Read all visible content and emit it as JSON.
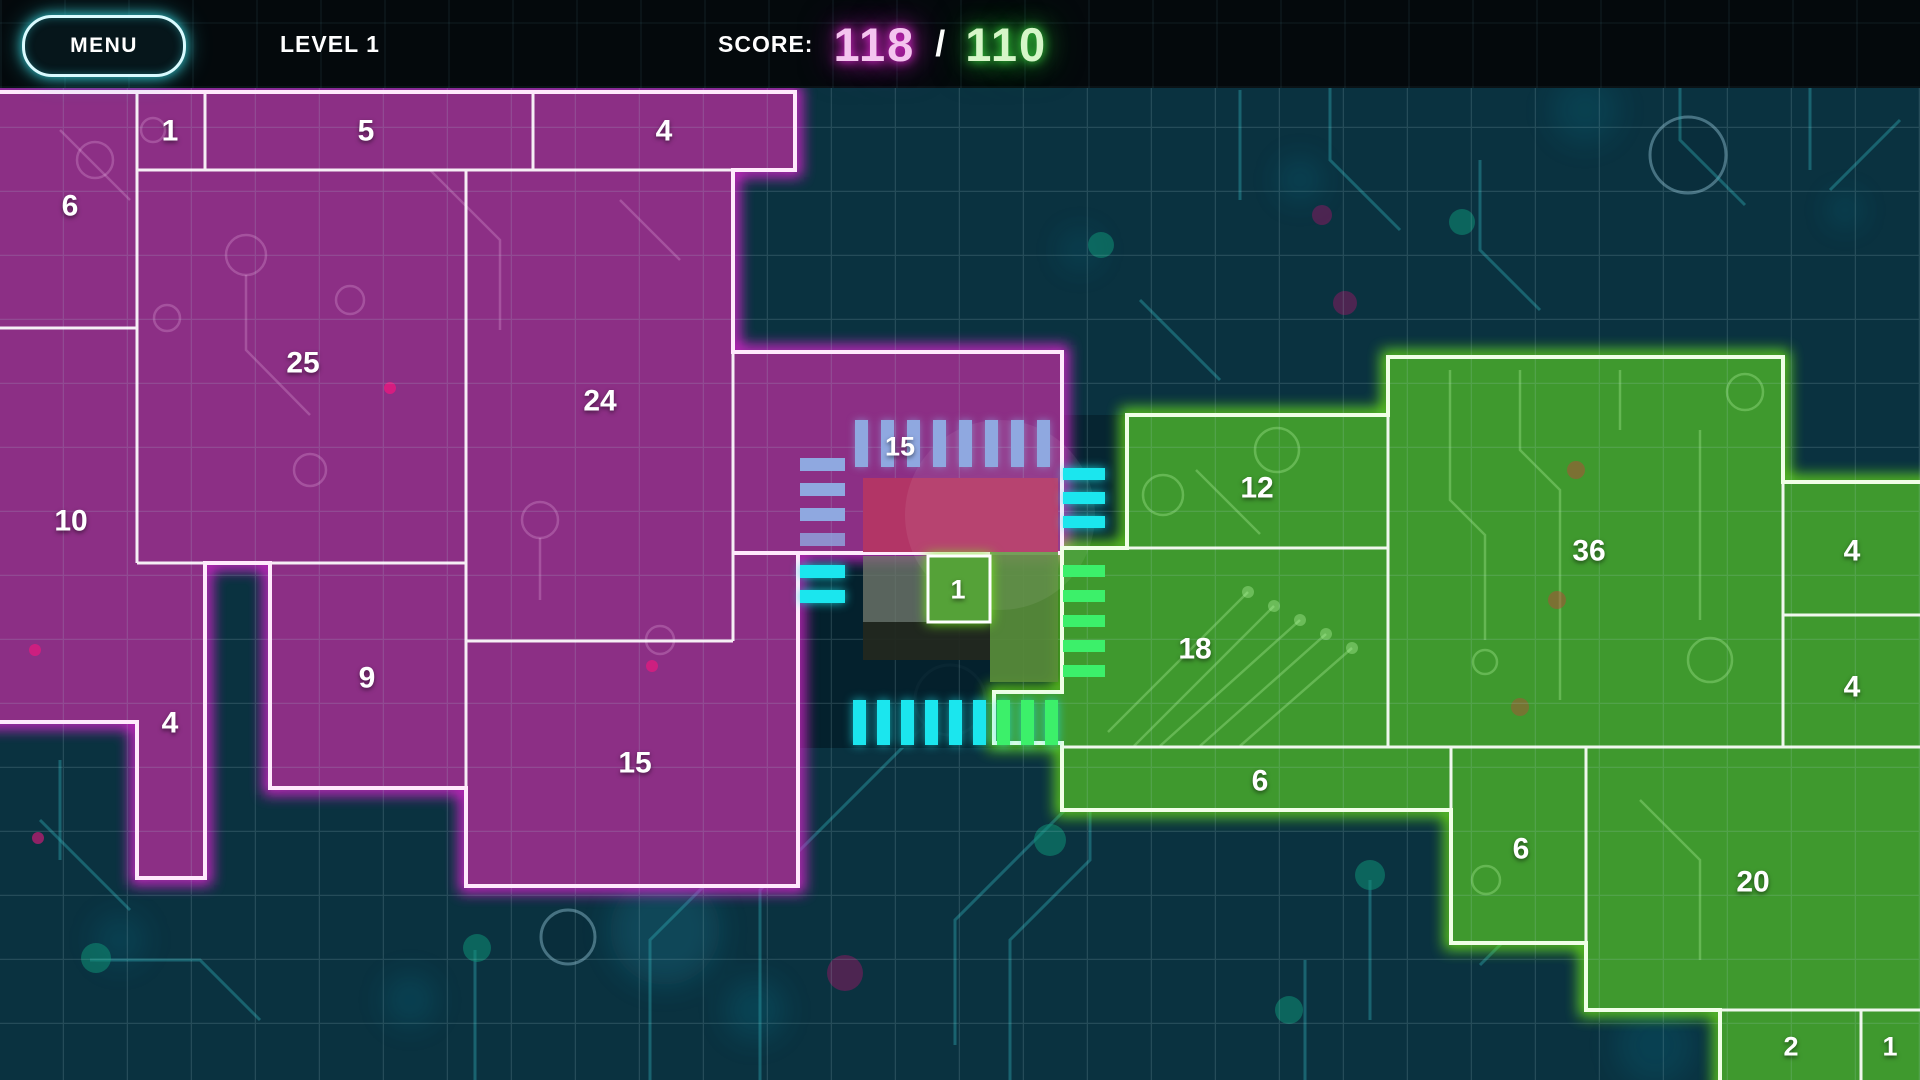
{
  "header": {
    "menu_label": "MENU",
    "level_label": "LEVEL 1",
    "score_label": "SCORE:",
    "score_current": "118",
    "score_divider": "/",
    "score_target": "110"
  },
  "board": {
    "magenta_regions": [
      {
        "value": "6"
      },
      {
        "value": "1"
      },
      {
        "value": "5"
      },
      {
        "value": "4"
      },
      {
        "value": "25"
      },
      {
        "value": "24"
      },
      {
        "value": "10"
      },
      {
        "value": "4"
      },
      {
        "value": "9"
      },
      {
        "value": "15"
      },
      {
        "value": "15"
      }
    ],
    "green_regions": [
      {
        "value": "12"
      },
      {
        "value": "36"
      },
      {
        "value": "4"
      },
      {
        "value": "4"
      },
      {
        "value": "18"
      },
      {
        "value": "6"
      },
      {
        "value": "6"
      },
      {
        "value": "20"
      },
      {
        "value": "2"
      },
      {
        "value": "1"
      }
    ],
    "chip_cell": {
      "value": "1"
    }
  },
  "colors": {
    "bg": "#0a3240",
    "header_bg": "#04090c",
    "magenta_fill": "#8c2f85",
    "magenta_glow": "#f224dd",
    "magenta_edge": "#ffe9fc",
    "green_fill": "#3f992e",
    "green_glow": "#76f518",
    "green_edge": "#f0ffe6",
    "divider": "#ffffff",
    "chip_crimson": "#b23566",
    "pin_blue": "#8fa8e0",
    "pin_cyan": "#1be6ee",
    "pin_green": "#3cf06a",
    "score_magenta": "#f4c4ef",
    "score_green": "#d6f6c8",
    "menu_border": "#d9fbff"
  }
}
